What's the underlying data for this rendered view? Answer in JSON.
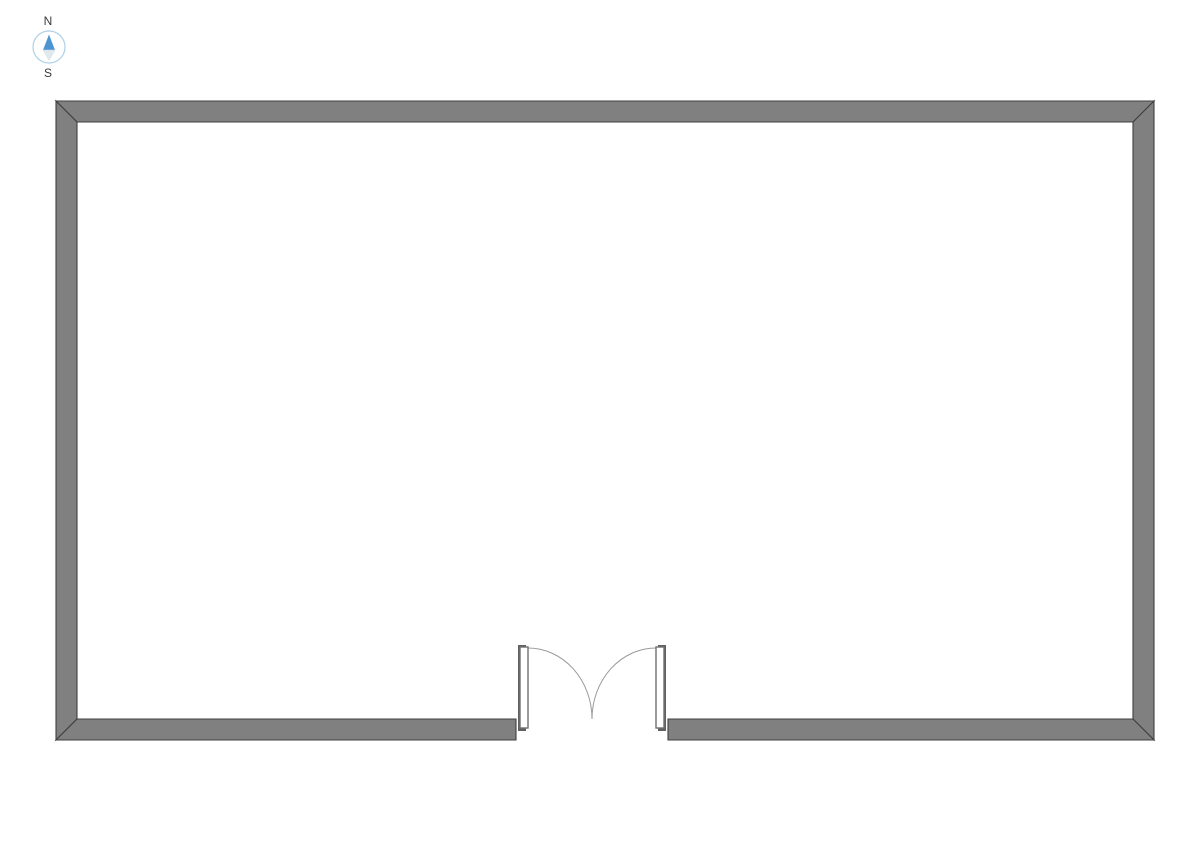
{
  "compass": {
    "north_label": "N",
    "south_label": "S"
  },
  "floor_plan": {
    "room_shape": "rectangle",
    "door": "double-swing-door-bottom-center"
  },
  "colors": {
    "background": "#ffffff",
    "wall_fill": "#808080",
    "wall_outline": "#3f3f3f",
    "door_panel_dark": "#606060",
    "door_leaf_fill": "#ffffff",
    "door_leaf_outline": "#707070",
    "swing_arc": "#999999",
    "compass_ring": "#aed1e6",
    "compass_north": "#4d95d2",
    "compass_south": "#e2e9ee",
    "label_text": "#3b3b3b"
  }
}
